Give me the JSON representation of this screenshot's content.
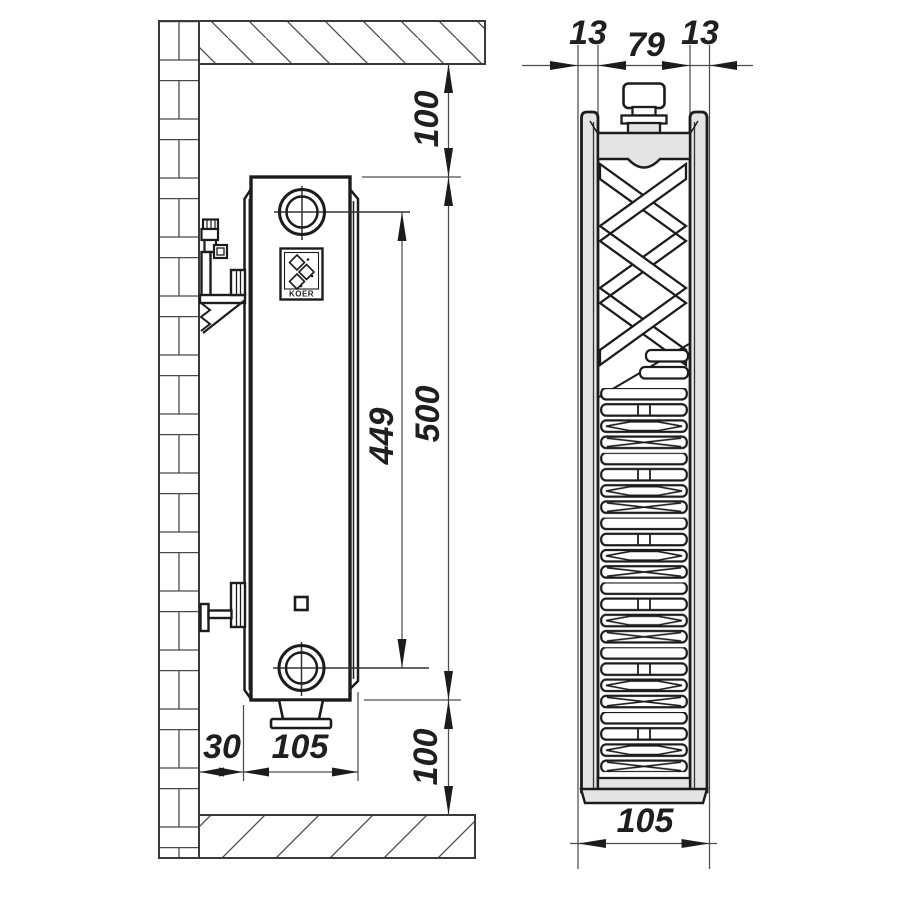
{
  "drawing": {
    "brand": "KOER",
    "side_view": {
      "dim_top_clearance": "100",
      "dim_height": "500",
      "dim_port_spacing": "449",
      "dim_bottom_clearance": "100",
      "dim_wall_gap": "30",
      "dim_depth": "105"
    },
    "front_view": {
      "dim_panel_left": "13",
      "dim_core_width": "79",
      "dim_panel_right": "13",
      "dim_total_depth": "105"
    },
    "colors": {
      "line": "#1c1c1c",
      "dim_line": "#4d4d4d",
      "light_fill": "#e4e4e4",
      "background": "#ffffff"
    }
  }
}
